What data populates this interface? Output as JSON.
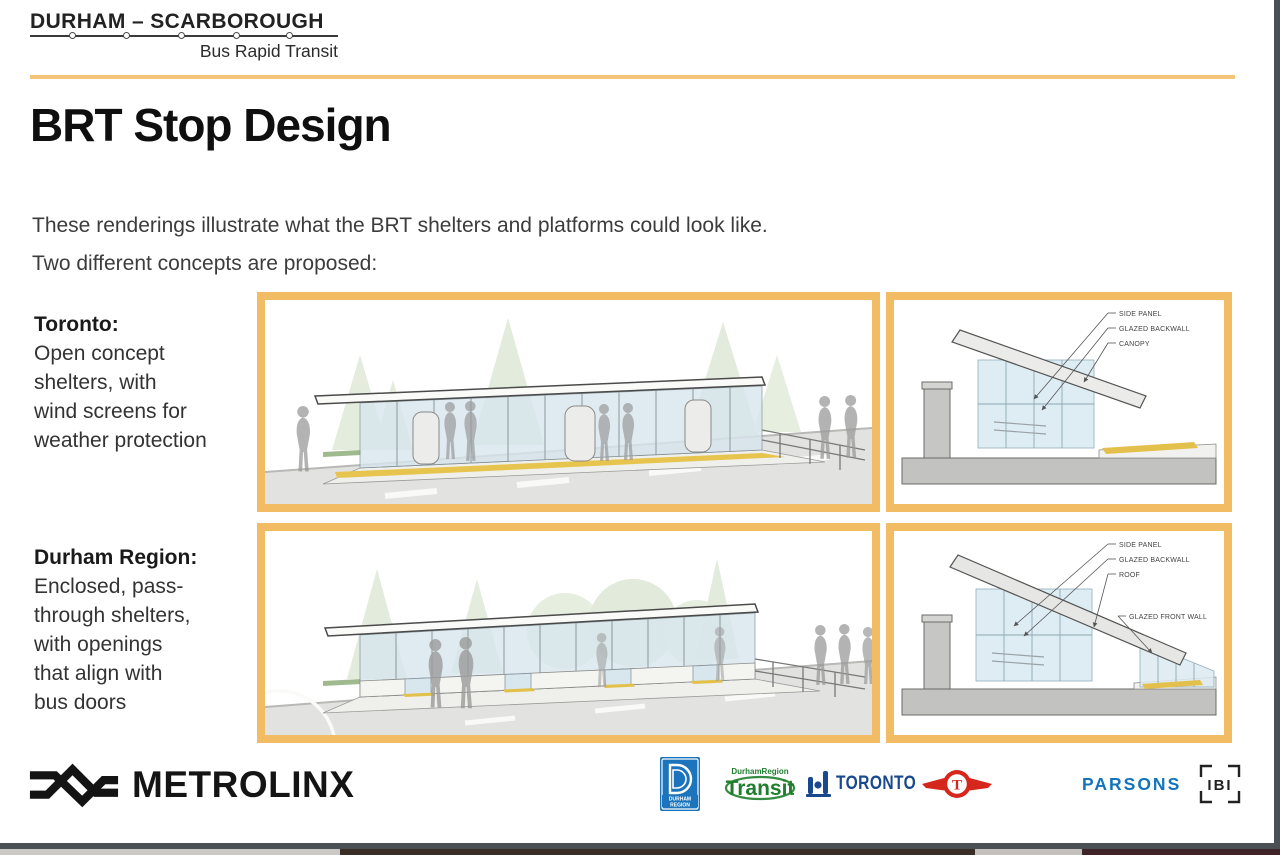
{
  "header": {
    "brand_title": "DURHAM – SCARBOROUGH",
    "brand_subtitle": "Bus Rapid Transit"
  },
  "slide": {
    "title": "BRT Stop Design",
    "intro": [
      "These renderings illustrate what the BRT shelters and platforms could look like.",
      "Two different concepts are proposed:"
    ]
  },
  "concepts": [
    {
      "name": "Toronto:",
      "desc_lines": [
        "Open concept",
        "shelters, with",
        "wind screens for",
        "weather protection"
      ],
      "callouts": [
        "SIDE PANEL",
        "GLAZED BACKWALL",
        "CANOPY"
      ]
    },
    {
      "name": "Durham Region:",
      "desc_lines": [
        "Enclosed, pass-",
        "through shelters,",
        "with openings",
        "that align with",
        "bus doors"
      ],
      "callouts": [
        "SIDE PANEL",
        "GLAZED BACKWALL",
        "ROOF",
        "GLAZED FRONT WALL"
      ]
    }
  ],
  "footer": {
    "metrolinx_label": "METROLINX",
    "durham_logo": {
      "letter": "D",
      "line1": "DURHAM",
      "line2": "REGION"
    },
    "transit_logo": {
      "top": "DurhamRegion",
      "main": "Transit"
    },
    "toronto_label": "TORONTO",
    "ttc_letter": "T",
    "parsons_label": "PARSONS",
    "ibi_label": "IBI"
  },
  "colors": {
    "accent": "#F1BC64",
    "rule": "#F4C47A",
    "parsons": "#1274BC",
    "toronto": "#19488E",
    "ttc": "#D6271D",
    "transit": "#1F7E2E",
    "durham": "#1C75BC"
  }
}
